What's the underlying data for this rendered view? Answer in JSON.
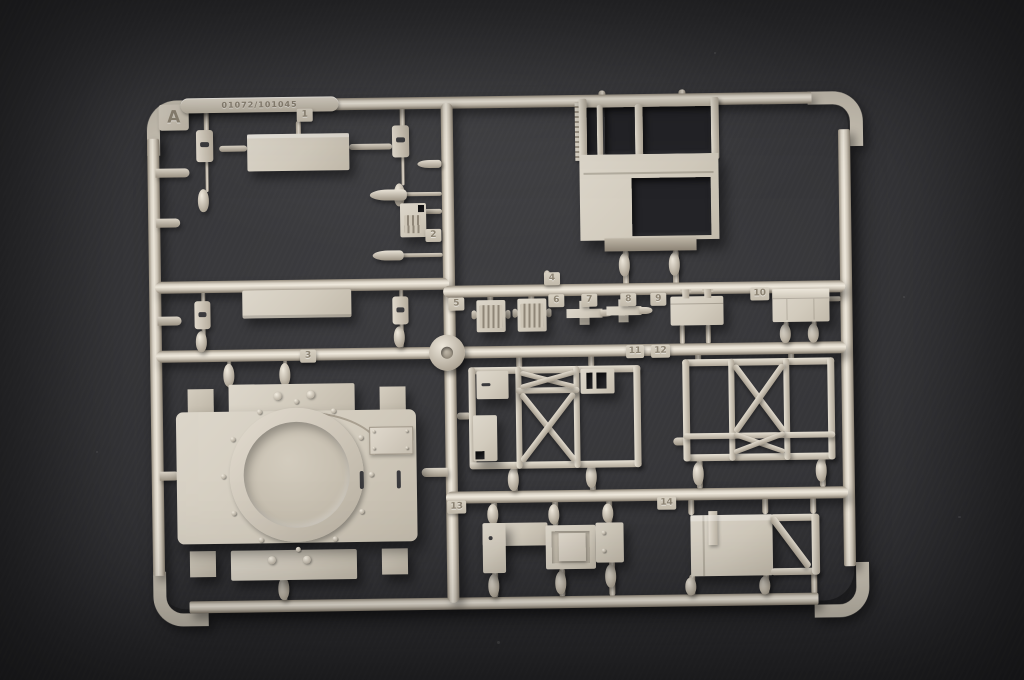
{
  "sprue": {
    "letter": "A",
    "mold_stamp": "01072/101045",
    "tabs": [
      "1",
      "2",
      "3",
      "4",
      "5",
      "6",
      "7",
      "8",
      "9",
      "10",
      "11",
      "12",
      "13",
      "14"
    ],
    "colors": {
      "plastic": "#d6cfc2",
      "plastic_highlight": "#efe9dd",
      "plastic_shadow": "#8a8173",
      "background_surface": "#313134"
    }
  }
}
